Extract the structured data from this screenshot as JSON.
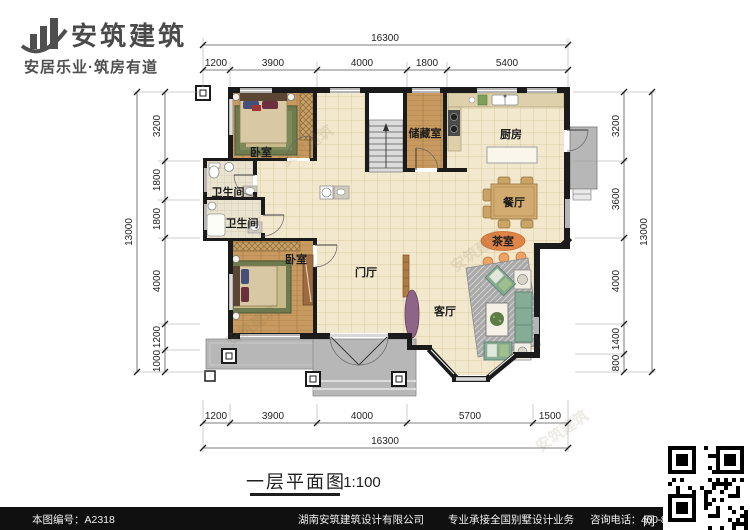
{
  "header": {
    "brand": "安筑建筑",
    "slogan": "安居乐业·筑房有道"
  },
  "title_block": {
    "name": "一层平面图",
    "scale": "1:100"
  },
  "plan": {
    "rooms": {
      "bedroom_top": "卧室",
      "storage": "储藏室",
      "kitchen": "厨房",
      "bath_upper": "卫生间",
      "bath_lower": "卫生间",
      "dining": "餐厅",
      "tea": "茶室",
      "bedroom_bottom": "卧室",
      "foyer": "门厅",
      "living": "客厅"
    }
  },
  "dimensions": {
    "top": {
      "total": "16300",
      "segments": [
        "1200",
        "3900",
        "4000",
        "1800",
        "5400"
      ]
    },
    "bottom": {
      "total": "16300",
      "segments": [
        "1200",
        "3900",
        "4000",
        "5700",
        "1500"
      ]
    },
    "left": {
      "total": "13000",
      "segments": [
        "3200",
        "1800",
        "1800",
        "4000",
        "1200",
        "1000"
      ]
    },
    "right": {
      "total": "13000",
      "segments": [
        "3200",
        "3600",
        "4000",
        "1400",
        "800"
      ]
    }
  },
  "watermark": {
    "text": "安筑建筑"
  },
  "footer": {
    "sheet_label": "本图编号：A2318",
    "company": "湖南安筑建筑设计有限公司",
    "business": "专业承接全国别墅设计业务",
    "phone_label": "咨询电话：400-8070-511",
    "net": "网"
  },
  "colors": {
    "wall": "#1b1b1b",
    "tile_floor": "#f2e8cd",
    "wood_floor": "#c89a5f",
    "accent_orange": "#e08347",
    "sofa_green": "#86ab97",
    "footer_bg": "#101010"
  }
}
